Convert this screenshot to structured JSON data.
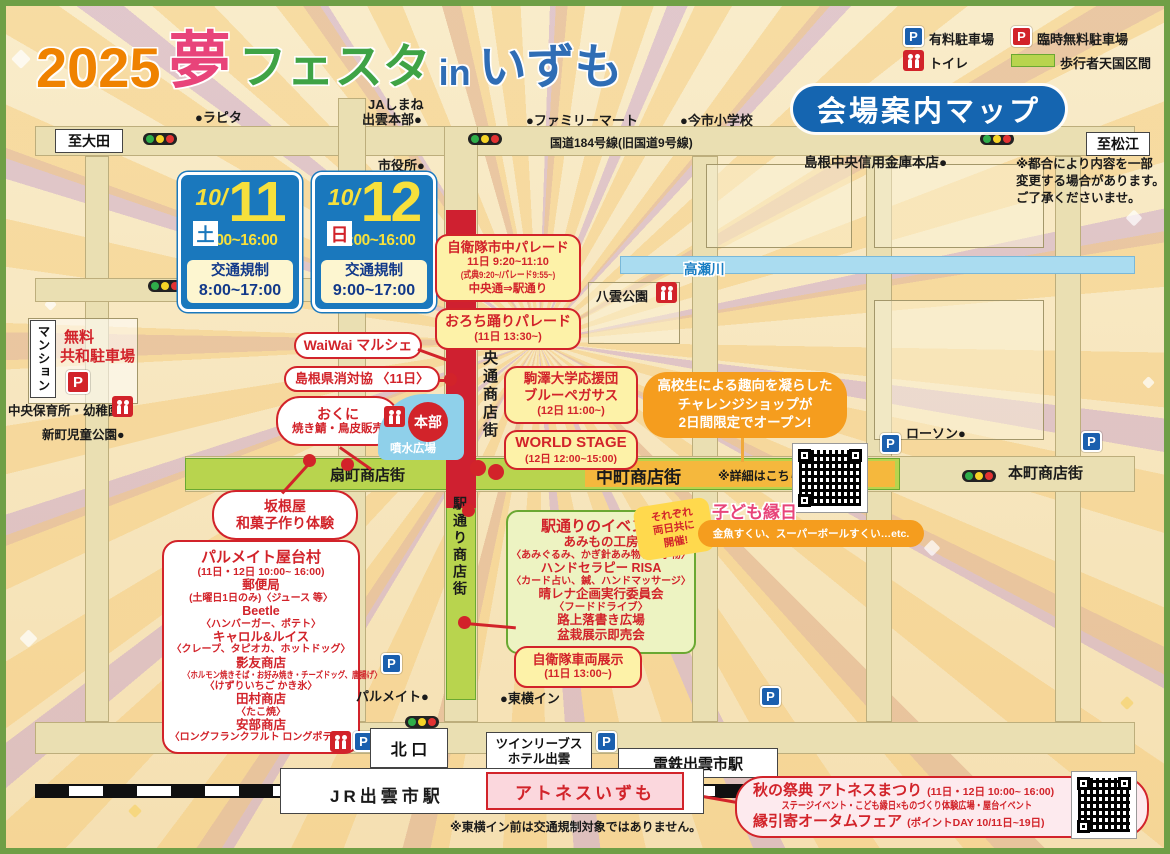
{
  "header": {
    "title": {
      "year": "2025",
      "yume": "夢",
      "festa": "フェスタ",
      "in_word": "in",
      "izumo": "いずも"
    },
    "badge": "会場案内マップ",
    "legend": {
      "p": "P",
      "paid": "有料駐車場",
      "temp_free": "臨時無料駐車場",
      "toilet": "トイレ",
      "pedestrian": "歩行者天国区間"
    }
  },
  "notice": {
    "l1": "※都合により内容を一部",
    "l2": "変更する場合があります。",
    "l3": "ご了承くださいませ。"
  },
  "directions": {
    "west": "至大田",
    "east": "至松江"
  },
  "dates": [
    {
      "prefix": "10/",
      "day": "11",
      "dow": "土",
      "hours": "9:00~16:00",
      "reg": "交通規制",
      "reg_hours": "8:00~17:00"
    },
    {
      "prefix": "10/",
      "day": "12",
      "dow": "日",
      "hours": "10:00~16:00",
      "reg": "交通規制",
      "reg_hours": "9:00~17:00"
    }
  ],
  "landmarks": {
    "lapita": "●ラピタ",
    "ja1": "JAしまね",
    "ja2": "出雲本部●",
    "cityhall": "市役所●",
    "familymart": "●ファミリーマート",
    "imaichi": "●今市小学校",
    "route184": "国道184号線(旧国道9号線)",
    "shinkin": "島根中央信用金庫本店●",
    "yakumo": "八雲公園",
    "takase": "高瀬川",
    "lawson": "ローソン●",
    "mansion": "マンション",
    "free1": "無料",
    "free2": "共和駐車場",
    "hoikusho": "中央保育所・幼稚園●",
    "shinmachi": "新町児童公園●",
    "palmate": "パルメイト●",
    "toyoko": "●東横イン"
  },
  "streets": {
    "chuo": "中央通商店街",
    "eki": "駅通り商店街",
    "ogi": "扇町商店街",
    "naka": "中町商店街",
    "hon": "本町商店街",
    "detail": "※詳細はこちら→"
  },
  "callouts": {
    "parade1": {
      "l0": "自衛隊市中パレード",
      "l1": "11日 9:20~11:10",
      "l2": "(式典9:20~/パレード9:55~)",
      "l3": "中央通⇒駅通り"
    },
    "parade2": {
      "l0": "おろち踊りパレード",
      "l1": "(11日 13:30~)"
    },
    "waiwai": "WaiWai マルシェ",
    "shodaikyo": "島根県消対協 〈11日〉",
    "okuni": {
      "l0": "おくに",
      "l1": "焼き鯖・鳥皮販売"
    },
    "honbu": "本部",
    "funsui": "噴水広場",
    "komazawa": {
      "l0": "駒澤大学応援団",
      "l1": "ブルーペガサス",
      "l2": "(12日 11:00~)"
    },
    "worldstage": {
      "l0": "WORLD STAGE",
      "l1": "(12日 12:00~15:00)"
    },
    "challenge": {
      "l0": "高校生による趣向を凝らした",
      "l1": "チャレンジショップが",
      "l2": "2日間限定でオープン!"
    },
    "sakaneya": {
      "l0": "坂根屋",
      "l1": "和菓子作り体験"
    },
    "vehicle": {
      "l0": "自衛隊車両展示",
      "l1": "(11日 13:00~)"
    },
    "kodomo": {
      "title": "子ども縁日",
      "items": "金魚すくい、スーパーボールすくい…etc."
    },
    "ryojitsu": {
      "l0": "それぞれ",
      "l1": "両日共に",
      "l2": "開催!"
    },
    "ekievents": {
      "title": "駅通りのイベント",
      "l1": "あみもの工房",
      "l2": "〈あみぐるみ、かぎ針あみ物、布小物〉",
      "l3": "ハンドセラピー RISA",
      "l4": "〈カード占い、鍼、ハンドマッサージ〉",
      "l5": "晴レナ企画実行委員会",
      "l6": "〈フードドライブ〉",
      "l7": "路上落書き広場",
      "l8": "盆栽展示即売会"
    },
    "yatai": {
      "title": "パルメイト屋台村",
      "l1": "(11日・12日 10:00~ 16:00)",
      "l2": "郵便局",
      "l3": "(土曜日1日のみ)〈ジュース 等〉",
      "l4": "Beetle",
      "l5": "〈ハンバーガー、ポテト〉",
      "l6": "キャロル&ルイス",
      "l7": "〈クレープ、タピオカ、ホットドッグ〉",
      "l8": "影友商店",
      "l9": "〈ホルモン焼きそば・お好み焼き・チーズドッグ、唐揚げ〉",
      "l10": "〈けずりいちご かき氷〉",
      "l11": "田村商店",
      "l12": "〈たこ焼〉",
      "l13": "安部商店",
      "l14": "〈ロングフランクフルト ロングポテト〉"
    }
  },
  "stations": {
    "kitaguchi": "北 口",
    "twin1": "ツインリーブス",
    "twin2": "ホテル出雲",
    "dentetsu": "電鉄出雲市駅",
    "jr": "JR出雲市駅",
    "atnes": "アトネスいずも",
    "note": "※東横イン前は交通規制対象ではありません。"
  },
  "autumn": {
    "t1": "秋の祭典 アトネスまつり",
    "t1b": "(11日・12日 10:00~ 16:00)",
    "t2": "ステージイベント・こども縁日×ものづくり体験広場・屋台イベント",
    "t3": "縁引寄オータムフェア",
    "t3b": "(ポイントDAY 10/11日~19日)"
  },
  "colors": {
    "accent_red": "#d2232a",
    "road_green": "#b8d44e",
    "nakamachi_yellow": "#f5b83d",
    "badge_blue": "#1565b0",
    "date_blue": "#1a78bd",
    "orange": "#f59d1e",
    "river_blue": "#aadcf0",
    "title_orange": "#ef8200",
    "title_pink": "#e8447a",
    "title_green": "#3fa345",
    "title_blue": "#2f6db5"
  }
}
